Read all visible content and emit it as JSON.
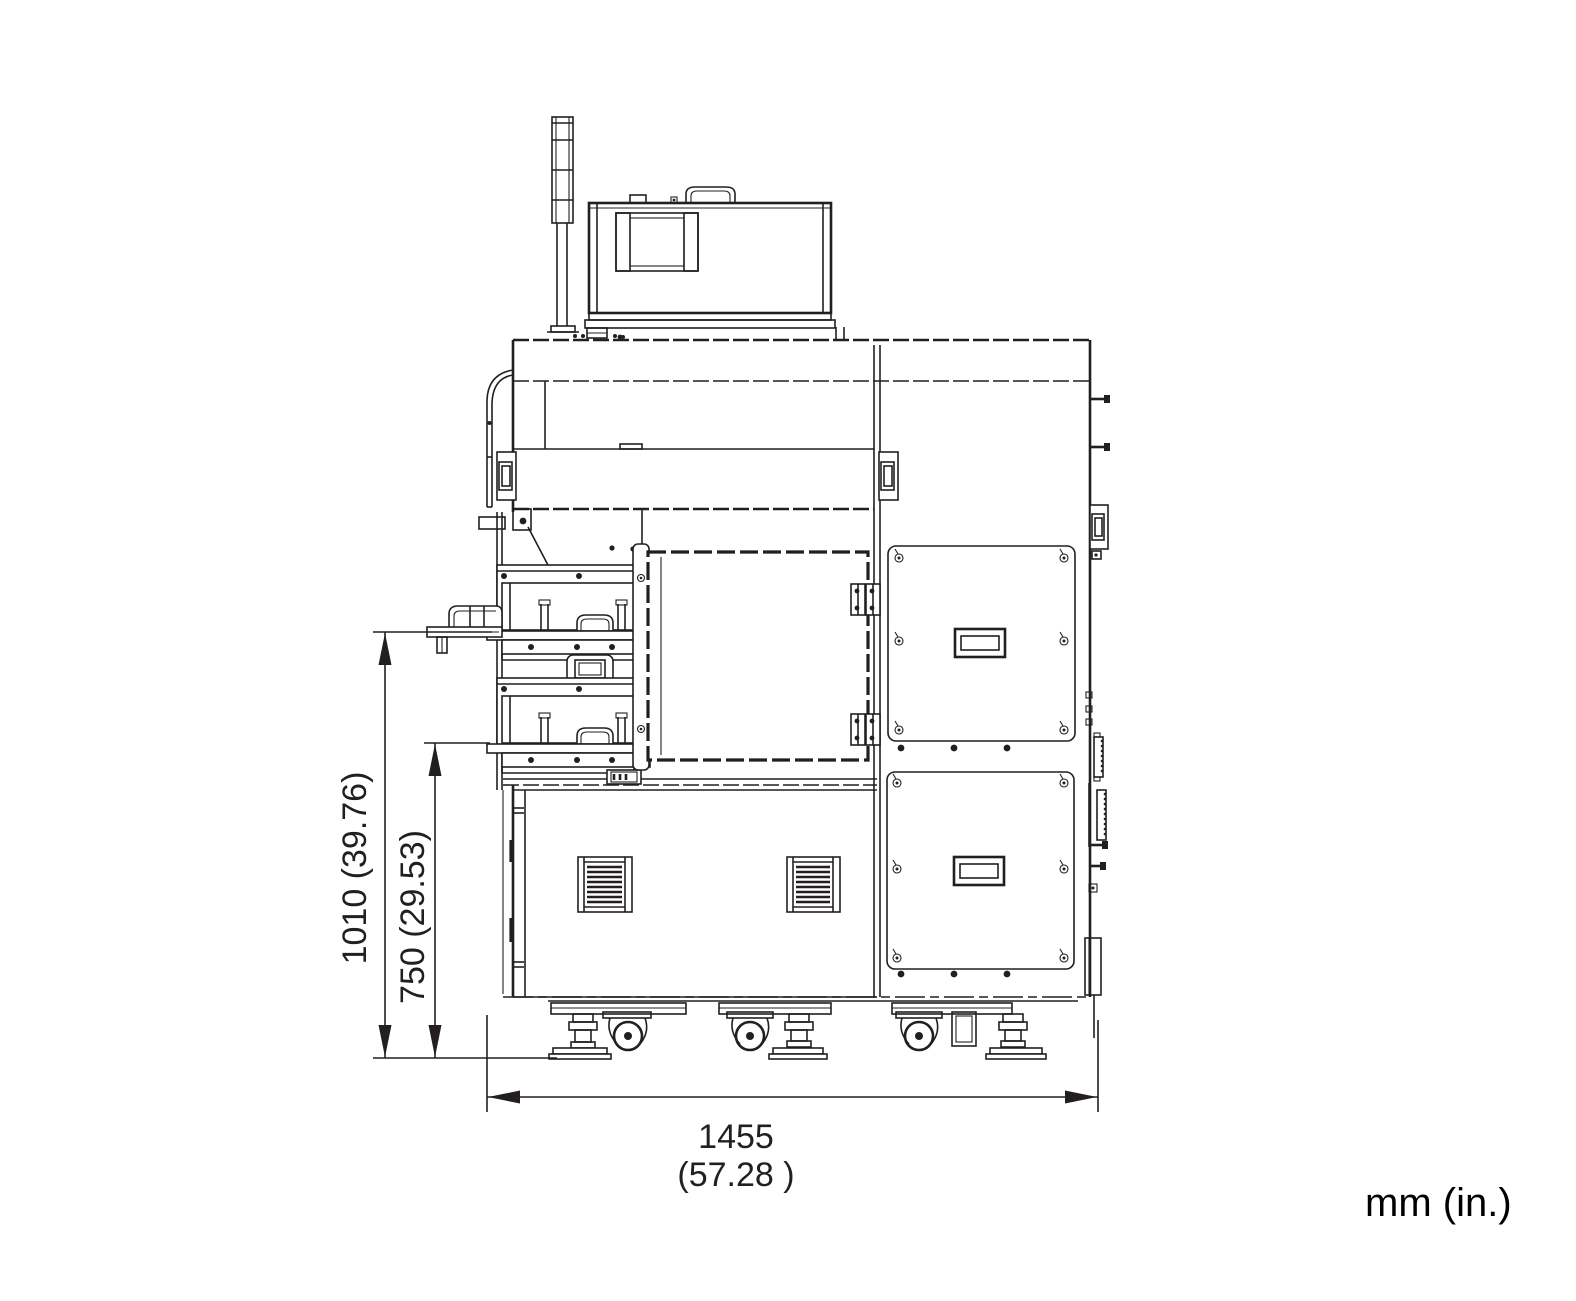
{
  "drawing": {
    "units_note": "mm (in.)",
    "dimensions": {
      "overall_height": {
        "label": "1010 (39.76)",
        "mm": 1010,
        "inches": 39.76
      },
      "table_height": {
        "label": "750 (29.53)",
        "mm": 750,
        "inches": 29.53
      },
      "overall_width": {
        "label_mm": "1455",
        "label_in": "(57.28  )",
        "mm": 1455,
        "inches": 57.28
      }
    },
    "colors": {
      "line": "#231f20",
      "background": "#ffffff"
    }
  }
}
